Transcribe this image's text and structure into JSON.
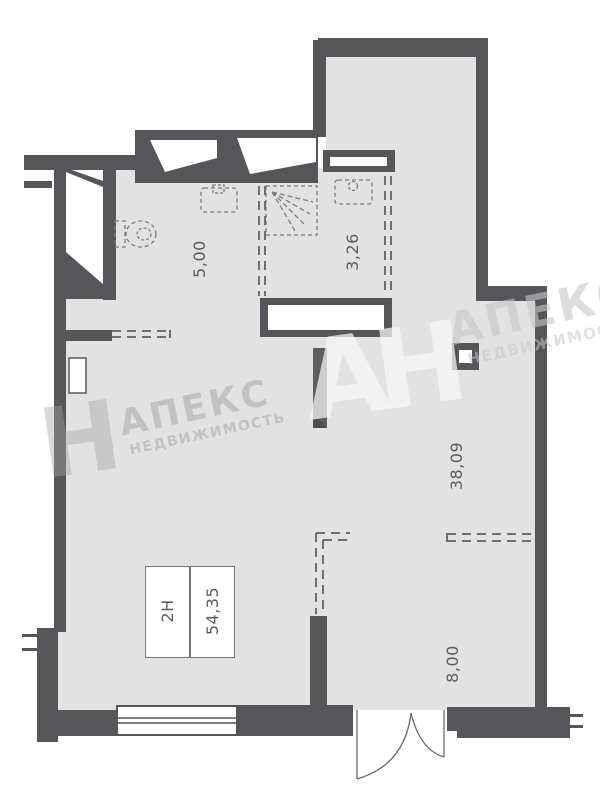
{
  "unit": {
    "number": "2Н",
    "total_area": "54,35"
  },
  "areas": {
    "bathroom": "5,00",
    "shower_room": "3,26",
    "main_room": "38,09",
    "entrance_zone": "8,00"
  },
  "watermark": {
    "brand": "АПЕКС",
    "tagline": "НЕДВИЖИМОСТЬ",
    "monogram": "АН",
    "monogram_left": "Н"
  },
  "colors": {
    "wall": "#56565a",
    "floor": "#e2e2e2",
    "dash": "#6f6f72",
    "label": "#5c5c5c"
  }
}
